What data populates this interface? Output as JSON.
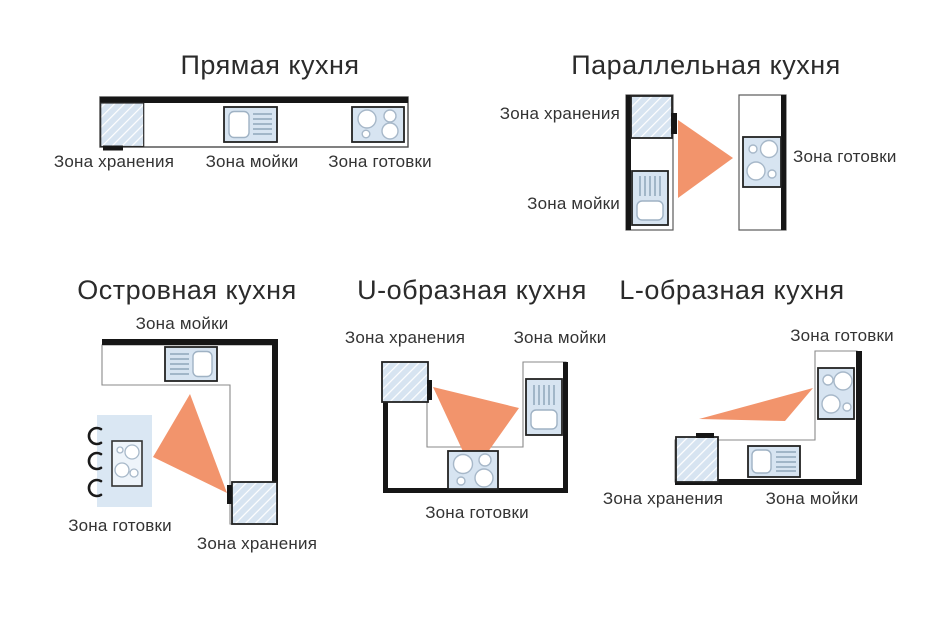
{
  "colors": {
    "background": "#ffffff",
    "work_triangle_orange": "#f2946c",
    "appliance_blue": "#d7e4f1",
    "island_blue": "#dae7f3",
    "wall_black": "#161616",
    "outline_gray": "#8a8a8a",
    "text_dark": "#2d2d2d"
  },
  "diagrams": [
    {
      "id": "straight",
      "title": "Прямая кухня",
      "labels": {
        "storage": "Зона хранения",
        "sink": "Зона мойки",
        "cooking": "Зона готовки"
      }
    },
    {
      "id": "parallel",
      "title": "Параллельная кухня",
      "labels": {
        "storage": "Зона хранения",
        "sink": "Зона мойки",
        "cooking": "Зона готовки"
      }
    },
    {
      "id": "island",
      "title": "Островная кухня",
      "labels": {
        "storage": "Зона хранения",
        "sink": "Зона мойки",
        "cooking": "Зона готовки"
      }
    },
    {
      "id": "u-shaped",
      "title": "U-образная кухня",
      "labels": {
        "storage": "Зона хранения",
        "sink": "Зона мойки",
        "cooking": "Зона готовки"
      }
    },
    {
      "id": "l-shaped",
      "title": "L-образная кухня",
      "labels": {
        "storage": "Зона хранения",
        "sink": "Зона мойки",
        "cooking": "Зона готовки"
      }
    }
  ]
}
